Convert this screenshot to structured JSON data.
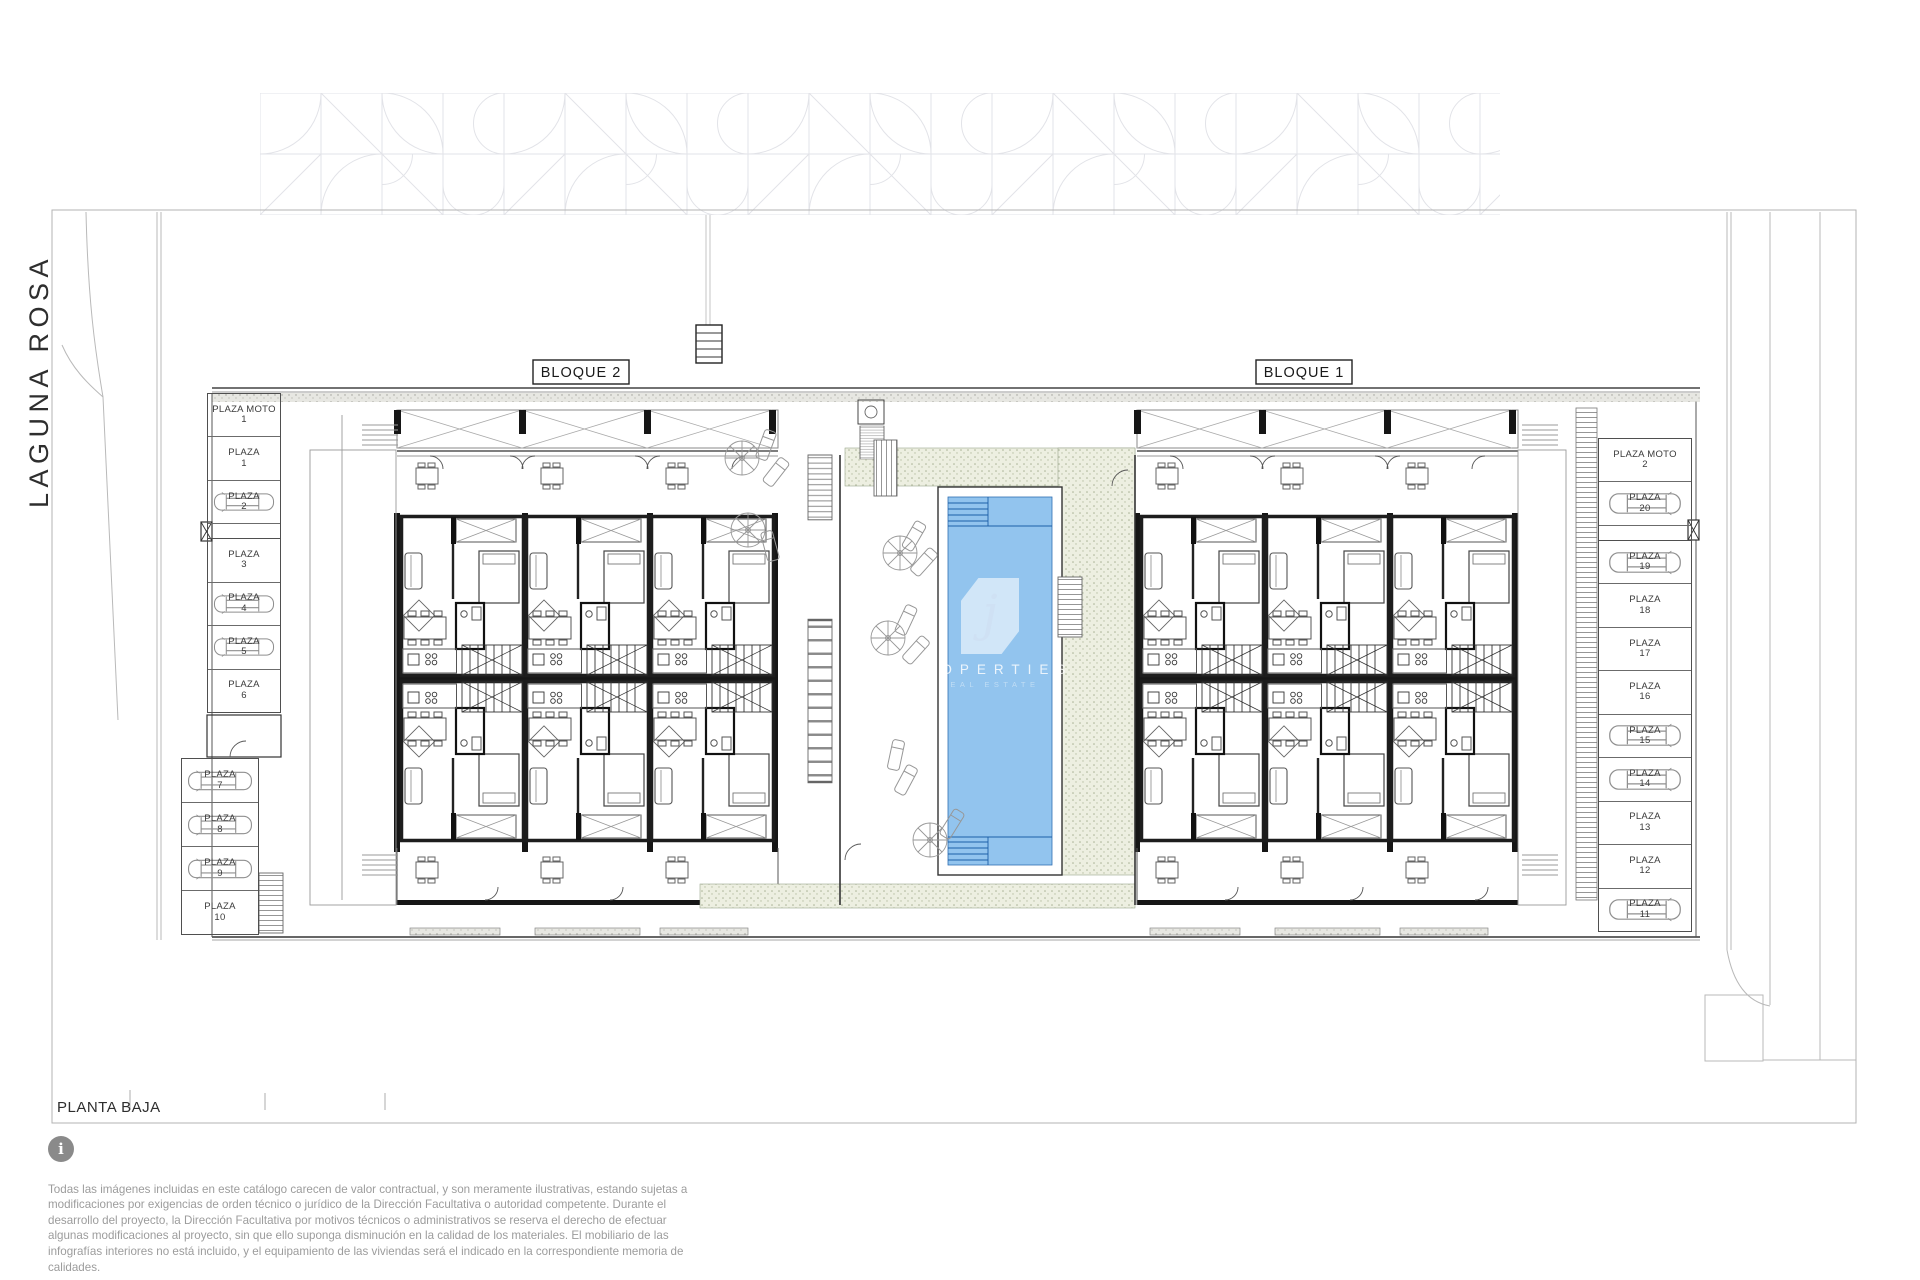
{
  "page": {
    "floor_label": "PLANTA BAJA",
    "street_name": "LAGUNA ROSA"
  },
  "blocks": {
    "block2_label": "BLOQUE 2",
    "block1_label": "BLOQUE 1"
  },
  "parking": {
    "left_upper": [
      {
        "name": "PLAZA MOTO",
        "num": "1",
        "car": false
      },
      {
        "name": "PLAZA",
        "num": "1",
        "car": false
      },
      {
        "name": "PLAZA",
        "num": "2",
        "car": true
      },
      {
        "name": "PLAZA",
        "num": "3",
        "car": false,
        "gap": true
      },
      {
        "name": "PLAZA",
        "num": "4",
        "car": true
      },
      {
        "name": "PLAZA",
        "num": "5",
        "car": true
      },
      {
        "name": "PLAZA",
        "num": "6",
        "car": false
      }
    ],
    "left_lower": [
      {
        "name": "PLAZA",
        "num": "7",
        "car": true
      },
      {
        "name": "PLAZA",
        "num": "8",
        "car": true
      },
      {
        "name": "PLAZA",
        "num": "9",
        "car": true
      },
      {
        "name": "PLAZA",
        "num": "10",
        "car": false
      }
    ],
    "right": [
      {
        "name": "PLAZA MOTO",
        "num": "2",
        "car": false
      },
      {
        "name": "PLAZA",
        "num": "20",
        "car": true
      },
      {
        "name": "PLAZA",
        "num": "19",
        "car": true,
        "gap": true
      },
      {
        "name": "PLAZA",
        "num": "18",
        "car": false
      },
      {
        "name": "PLAZA",
        "num": "17",
        "car": false
      },
      {
        "name": "PLAZA",
        "num": "16",
        "car": false
      },
      {
        "name": "PLAZA",
        "num": "15",
        "car": true
      },
      {
        "name": "PLAZA",
        "num": "14",
        "car": true
      },
      {
        "name": "PLAZA",
        "num": "13",
        "car": false
      },
      {
        "name": "PLAZA",
        "num": "12",
        "car": false
      },
      {
        "name": "PLAZA",
        "num": "11",
        "car": true
      }
    ]
  },
  "watermark": {
    "letter": "j",
    "line1": "PROPERTIES",
    "line2": "REAL ESTATE"
  },
  "footer": {
    "info_symbol": "i",
    "disclaimer": "Todas las imágenes incluidas en este catálogo carecen de valor contractual, y son meramente ilustrativas, estando sujetas a modificaciones por exigencias de orden técnico o jurídico de la Dirección Facultativa o autoridad competente. Durante el desarrollo del proyecto, la Dirección Facultativa por motivos técnicos o administrativos se reserva el derecho de efectuar algunas modificaciones al proyecto, sin que ello suponga disminución en la calidad de los materiales. El mobiliario de las infografías interiores no está incluido, y el equipamiento de las viviendas será el indicado en la correspondiente memoria de calidades."
  },
  "colors": {
    "pool_fill": "#92c4ee",
    "pool_line": "#2f6fb2",
    "deck_base": "#edefe1",
    "wall": "#161616"
  }
}
